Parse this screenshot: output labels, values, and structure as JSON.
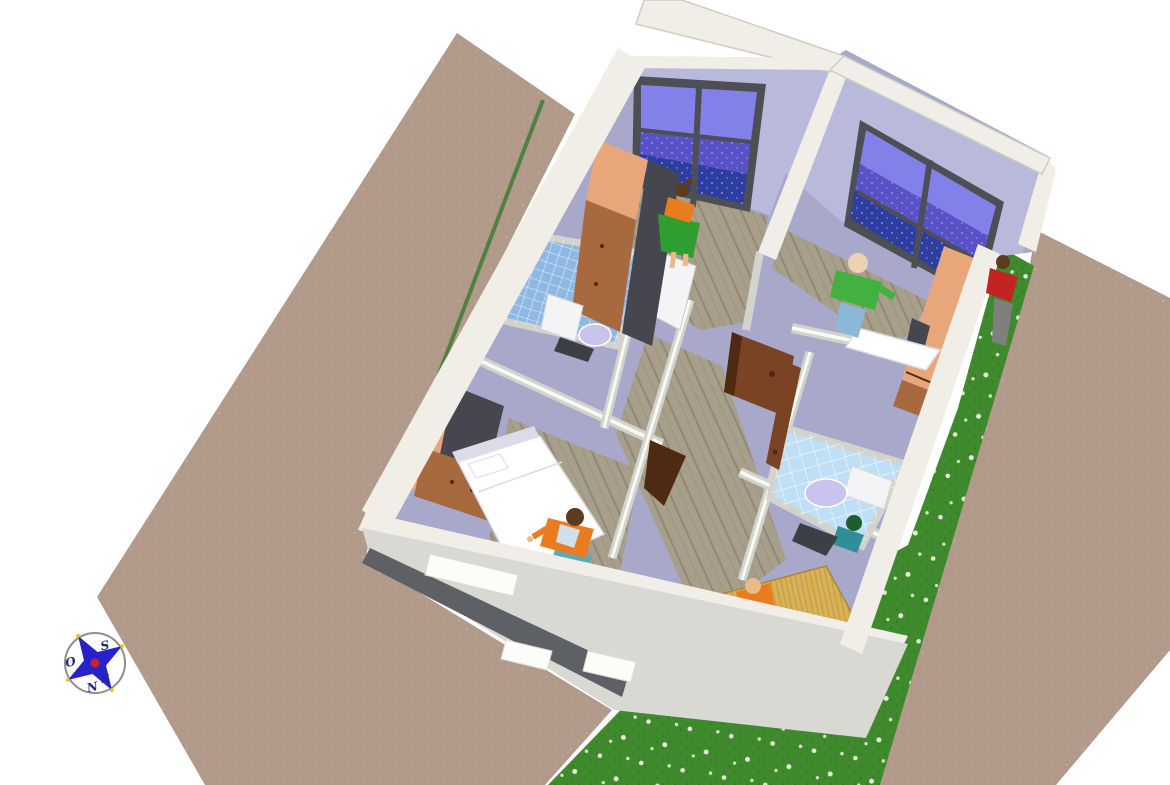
{
  "scene": {
    "view": "3d-overhead-dollhouse-render",
    "rooms": [
      "bedroom-top",
      "bedroom-right",
      "bedroom-left",
      "bathroom-top",
      "bathroom-right",
      "hallway",
      "study"
    ],
    "people": [
      {
        "name": "woman-green-dress",
        "room": "bedroom-top"
      },
      {
        "name": "man-green-jacket",
        "room": "bedroom-right"
      },
      {
        "name": "person-orange-jacket",
        "room": "bedroom-left"
      },
      {
        "name": "person-orange-overalls",
        "room": "study"
      },
      {
        "name": "person-red-shirt",
        "room": "yard"
      }
    ],
    "furniture": [
      "wardrobes",
      "double-bed",
      "single-bed",
      "bathroom-sink",
      "toilet",
      "desk",
      "office-chair",
      "interior-doors"
    ]
  },
  "compass": {
    "letters": {
      "o": "O",
      "s": "S",
      "n": "N",
      "n2": "N"
    }
  },
  "colors": {
    "background": "#ffffff",
    "ground_tan": "#b29a8b",
    "tan_speckle": "#c6b2a4",
    "grass": "#3e8a2d",
    "grass_dark": "#2c6e21",
    "daisy": "#eef3e1",
    "edge_green": "#3f7d33",
    "wall_white": "#f0eee7",
    "wall_edge": "#cfcdc2",
    "wall_gray": "#d9d9d4",
    "foundation": "#5d6165",
    "sill_white": "#fcfcf9",
    "interior_wall": "#a7a8ca",
    "interior_wall_light": "#b9badb",
    "inner_band_gray": "#d3d3cd",
    "inner_band_white": "#fafaf5",
    "wood_floor": "#a89f8b",
    "wood_line": "#756d5c",
    "tile_wall": "#8fb9e3",
    "tile_floor": "#bedff5",
    "grout": "#f4f9ff",
    "window_frame": "#4e4e55",
    "glass_light": "#8181e9",
    "glass_mid": "#5952c6",
    "glass_dark": "#2d3ea0",
    "glass_speckle": "#8fa2f2",
    "wardrobe_salmon": "#e7a77b",
    "wardrobe_dark": "#45464e",
    "wardrobe_brown": "#a76a3e",
    "door_brown": "#7a4424",
    "door_brown_dark": "#4e2a12",
    "bed_white": "#ffffff",
    "bed_shade": "#dcdce8",
    "desk_wood": "#d9b257",
    "desk_grain": "#ab8637",
    "toilet_lavender": "#c9c3ed",
    "fixture_white": "#f4f4f6",
    "fixture_dark": "#3c4045",
    "bag_blue": "#3748c5",
    "chair_gray": "#9b9ba3",
    "aquarium_teal": "#2f8f98",
    "plant_green": "#1e5e2e",
    "skin": "#e9ba8c",
    "skin_light": "#ecd2b0",
    "hair_brown": "#5e3a1f",
    "dress_green": "#2f9e30",
    "jacket_green": "#43b13f",
    "shirt_orange": "#e87c1e",
    "vest_blue": "#cfe0ea",
    "pants_teal": "#5aabb5",
    "jeans_blue": "#8cb8d8",
    "shirt_red": "#c32322",
    "pants_gray": "#7f7f7d",
    "compass_blue": "#2823c8",
    "compass_red": "#cc2222",
    "compass_ring": "#8f8f8f",
    "compass_text": "#1c2d7a",
    "compass_tick": "#e8c81e"
  }
}
